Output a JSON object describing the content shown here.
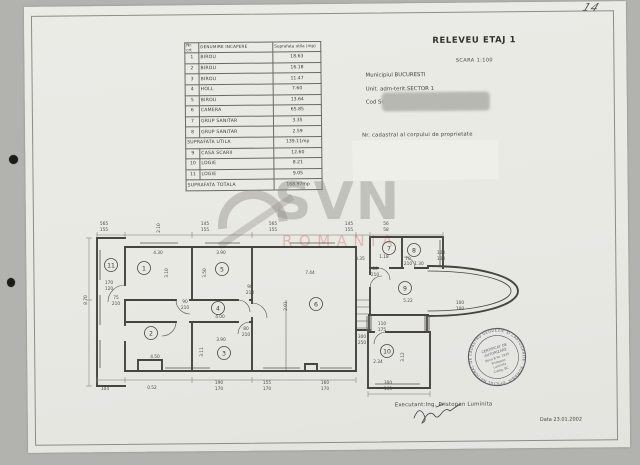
{
  "page": {
    "handwritten_number": "14"
  },
  "table": {
    "headers": {
      "nr": "Nr. crt",
      "name": "Denumire incapere",
      "area": "Suprafata utila (mp)"
    },
    "rows": [
      {
        "nr": "1",
        "name": "BIROU",
        "area": "18.63"
      },
      {
        "nr": "2",
        "name": "BIROU",
        "area": "16.18"
      },
      {
        "nr": "3",
        "name": "BIROU",
        "area": "11.47"
      },
      {
        "nr": "4",
        "name": "HOLL",
        "area": "7.60"
      },
      {
        "nr": "5",
        "name": "BIROU",
        "area": "13.64"
      },
      {
        "nr": "6",
        "name": "CAMERA",
        "area": "65.85"
      },
      {
        "nr": "7",
        "name": "GRUP SANITAR",
        "area": "3.35"
      },
      {
        "nr": "8",
        "name": "GRUP SANITAR",
        "area": "2.59"
      },
      {
        "nr": null,
        "name": "SUPRAFATA UTILA",
        "area": "139.11mp"
      },
      {
        "nr": "9",
        "name": "CASA SCARII",
        "area": "12.60"
      },
      {
        "nr": "10",
        "name": "LOGIE",
        "area": "8.21"
      },
      {
        "nr": "11",
        "name": "LOGIE",
        "area": "9.05"
      },
      {
        "nr": null,
        "name": "SUPRAFATA TOTALA",
        "area": "168.97mp"
      }
    ]
  },
  "header": {
    "title": "RELEVEU ETAJ 1",
    "scale": "SCARA 1:100",
    "location": [
      "Municipiul BUCURESTI",
      "Unit. adm-terit.SECTOR 1",
      "Cod SIRUTA 179141"
    ],
    "cadastral_label": "Nr. cadastral al corpului de proprietate"
  },
  "watermark": {
    "brand": "SVN",
    "country": "ROMANIA"
  },
  "plan": {
    "rooms": [
      [
        "1",
        144,
        268
      ],
      [
        "2",
        151,
        333
      ],
      [
        "3",
        224,
        353
      ],
      [
        "4",
        218,
        308
      ],
      [
        "5",
        222,
        269
      ],
      [
        "6",
        316,
        304
      ],
      [
        "7",
        389,
        248
      ],
      [
        "8",
        414,
        250
      ],
      [
        "9",
        405,
        288
      ],
      [
        "10",
        387,
        351
      ],
      [
        "11",
        111,
        265
      ]
    ],
    "labels": [
      [
        "565",
        104,
        225
      ],
      [
        "155",
        104,
        231
      ],
      [
        "145",
        205,
        225
      ],
      [
        "155",
        205,
        231
      ],
      [
        "565",
        273,
        225
      ],
      [
        "155",
        273,
        231
      ],
      [
        "145",
        349,
        225
      ],
      [
        "155",
        349,
        231
      ],
      [
        "56",
        386,
        225
      ],
      [
        "58",
        386,
        231
      ],
      [
        "2.10",
        160,
        228,
        -90
      ],
      [
        "4.30",
        158,
        254
      ],
      [
        "3.10",
        168,
        273,
        -90
      ],
      [
        "3.90",
        221,
        254
      ],
      [
        "3.50",
        206,
        273,
        -90
      ],
      [
        "4.00",
        220,
        318
      ],
      [
        "4.50",
        155,
        358
      ],
      [
        "3.90",
        221,
        341
      ],
      [
        "3.11",
        203,
        352,
        -90
      ],
      [
        "7.44",
        310,
        274
      ],
      [
        "8.35",
        360,
        260
      ],
      [
        "2.01",
        287,
        306,
        -90
      ],
      [
        "5.22",
        408,
        302
      ],
      [
        "2.34",
        378,
        363
      ],
      [
        "3.12",
        404,
        357,
        -90
      ],
      [
        "8.70",
        87,
        300,
        -90
      ],
      [
        "170",
        109,
        284
      ],
      [
        "120",
        109,
        290
      ],
      [
        "75",
        116,
        299
      ],
      [
        "210",
        116,
        305
      ],
      [
        "90",
        185,
        303
      ],
      [
        "210",
        185,
        309
      ],
      [
        "90",
        250,
        288
      ],
      [
        "210",
        250,
        294
      ],
      [
        "80",
        246,
        330
      ],
      [
        "210",
        246,
        336
      ],
      [
        "80",
        375,
        270
      ],
      [
        "210",
        375,
        276
      ],
      [
        "1.18",
        384,
        258
      ],
      [
        "70",
        408,
        260
      ],
      [
        "210",
        408,
        265
      ],
      [
        "1.30",
        419,
        265
      ],
      [
        "100",
        441,
        254
      ],
      [
        "100",
        441,
        260
      ],
      [
        "100",
        460,
        304
      ],
      [
        "100",
        460,
        310
      ],
      [
        "300",
        362,
        338
      ],
      [
        "250",
        362,
        344
      ],
      [
        "110",
        382,
        325
      ],
      [
        "175",
        382,
        331
      ],
      [
        "104",
        105,
        390
      ],
      [
        "0.52",
        152,
        389
      ],
      [
        "190",
        219,
        384
      ],
      [
        "170",
        219,
        390
      ],
      [
        "155",
        267,
        384
      ],
      [
        "170",
        267,
        390
      ],
      [
        "160",
        325,
        384
      ],
      [
        "170",
        325,
        390
      ],
      [
        "300",
        388,
        384
      ],
      [
        "163",
        388,
        390
      ]
    ]
  },
  "stamp": {
    "ring": "OFICIUL NATIONAL DE CADASTRU GEODEZIE SI CARTOGRAFIE · ROMANIA ·",
    "lines": [
      "CERTIFICAT DE",
      "AUTORIZARE",
      "Seria B Nr. 1935",
      "Pristopan",
      "Luminita",
      "Categ. BC"
    ]
  },
  "footer": {
    "executant": "Executant:Ing. Pristopan Luminita",
    "date": "Data 23.01.2002"
  }
}
